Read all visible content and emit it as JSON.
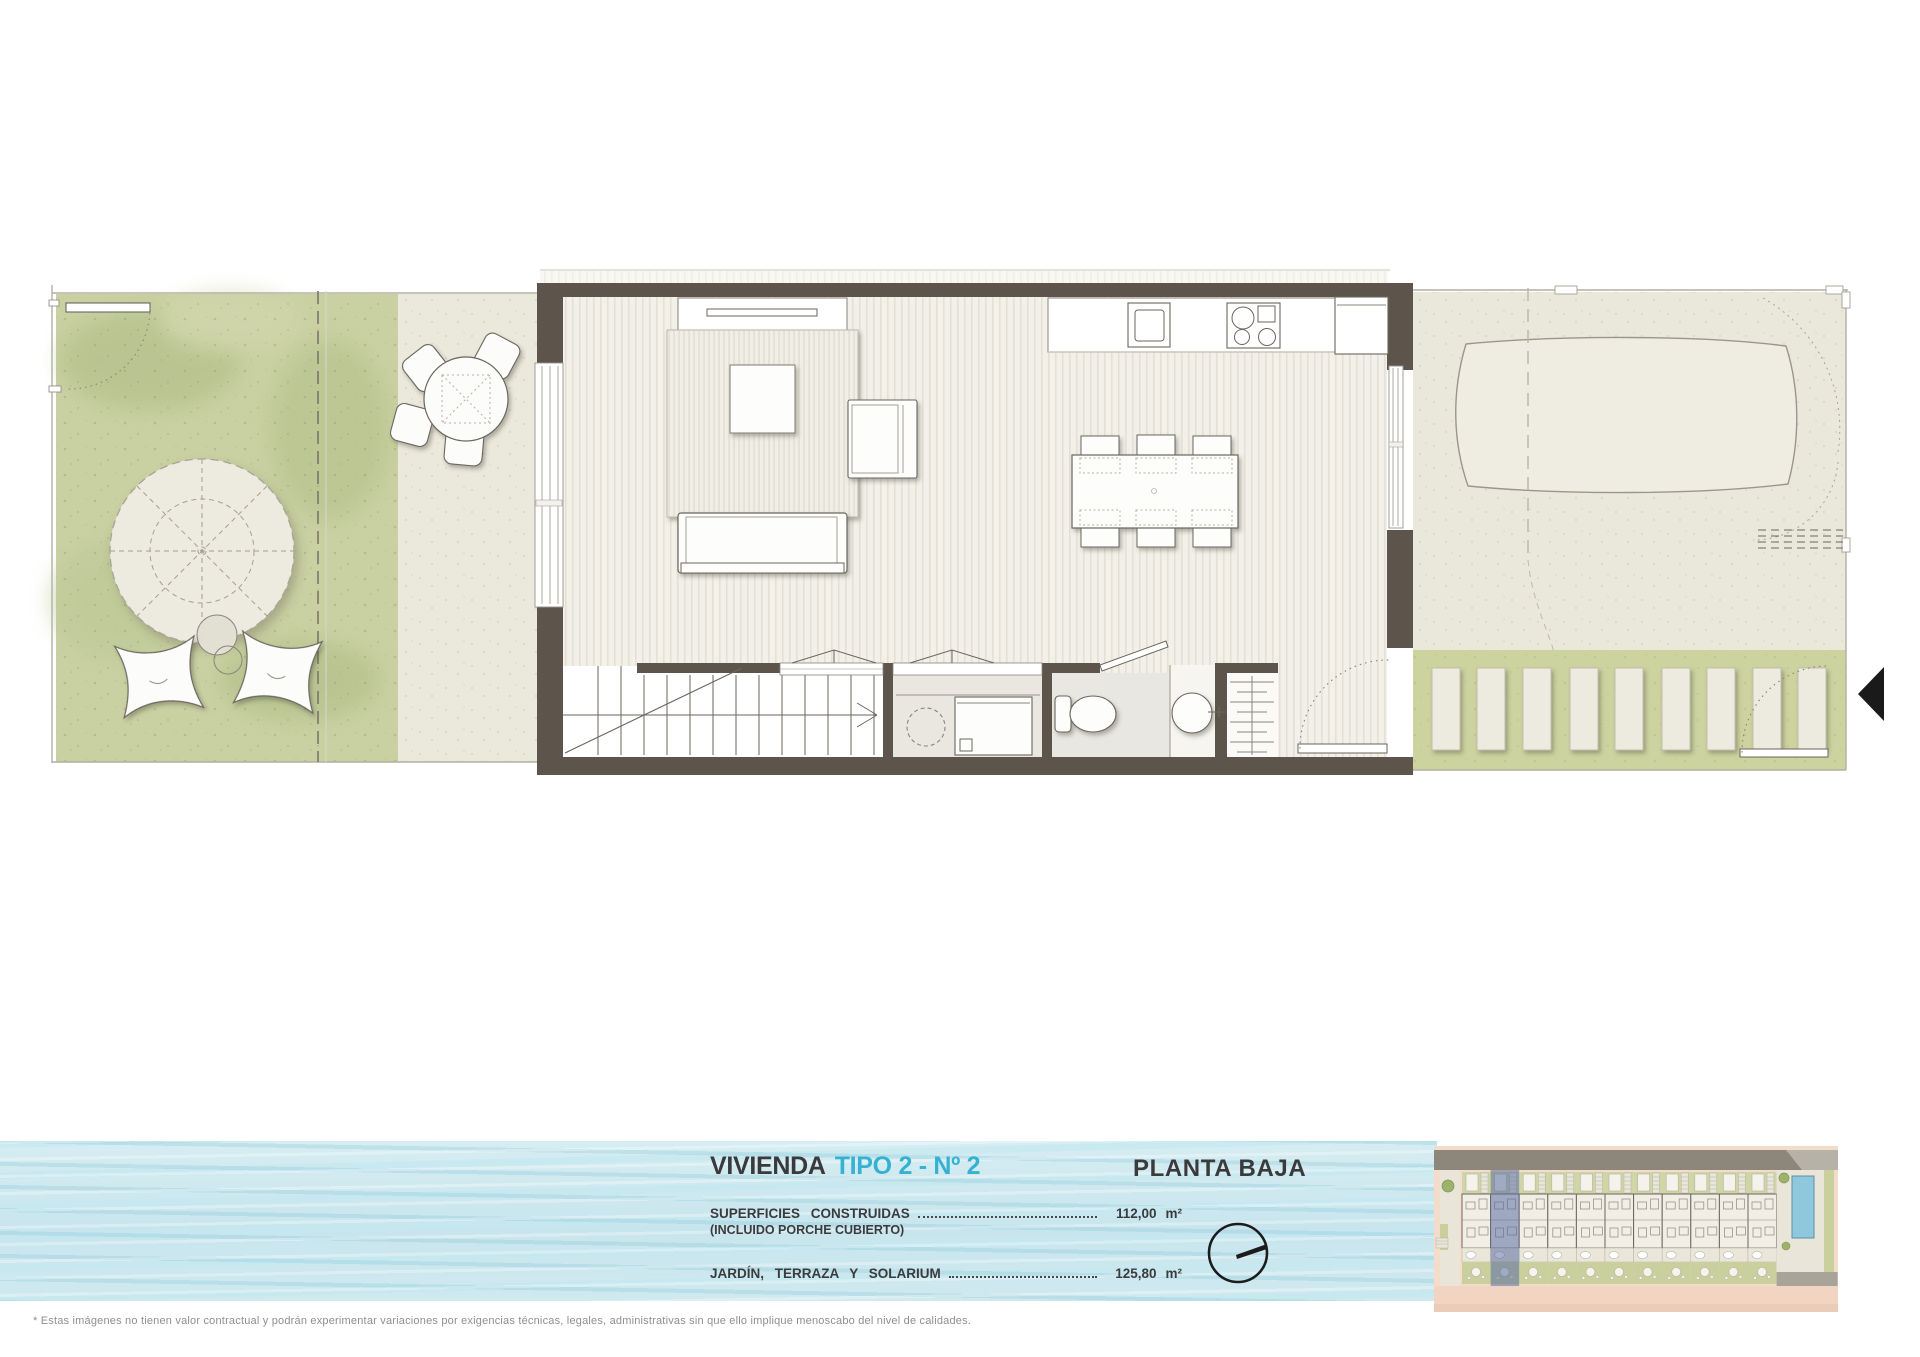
{
  "banner": {
    "title_prefix": "VIVIENDA",
    "title_highlight": "TIPO 2 - Nº 2",
    "plan_label": "PLANTA BAJA",
    "rows": [
      {
        "label": "SUPERFICIES  CONSTRUIDAS",
        "sublabel": "(INCLUIDO PORCHE CUBIERTO)",
        "value": "112,00",
        "unit": "m²"
      },
      {
        "label": "JARDÍN,  TERRAZA  Y  SOLARIUM",
        "sublabel": "",
        "value": "125,80",
        "unit": "m²"
      }
    ],
    "compass_icon": "north-arrow-icon"
  },
  "footer": {
    "disclaimer": "* Estas imágenes no tienen valor contractual y podrán experimentar variaciones por exigencias técnicas, legales, administrativas sin que ello implique menoscabo del nivel de calidades."
  },
  "site_plan": {
    "units_total": 11,
    "highlighted_unit": 2,
    "highlight_color": "#55689f",
    "pool_color": "#8fc8dd"
  },
  "colors": {
    "wall": "#5d554c",
    "lawn": "#c9d0a2",
    "terrace": "#ebe8dc",
    "deck_green": "#ccd39f",
    "water": "#cfe8ee",
    "accent_cyan": "#35b1d1",
    "text_dark": "#3b3b3d",
    "footer_gray": "#8f8f8f"
  }
}
